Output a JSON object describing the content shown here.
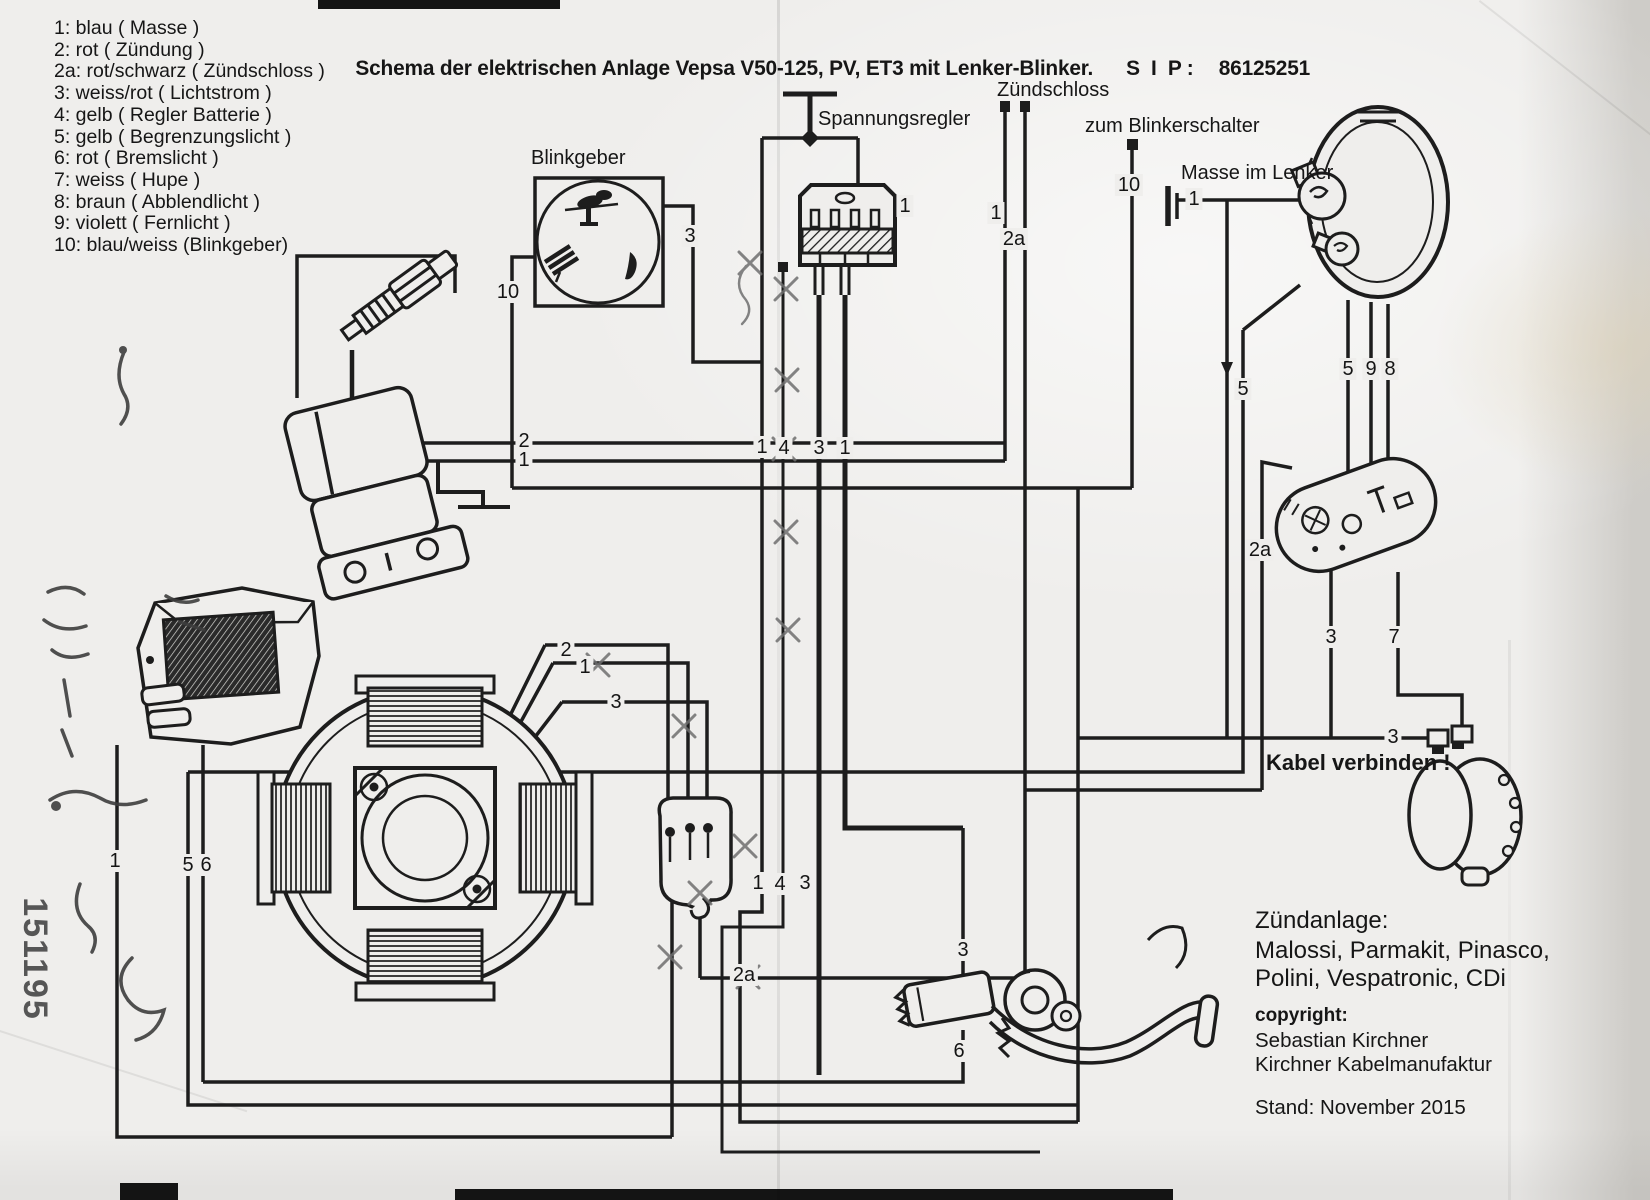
{
  "title": {
    "text": "Schema der elektrischen Anlage Vepsa V50-125, PV, ET3 mit Lenker-Blinker.",
    "sip_label": "S  I  P :",
    "sip_number": "86125251"
  },
  "legend": {
    "items": [
      "1: blau ( Masse )",
      "2: rot ( Zündung )",
      "2a: rot/schwarz ( Zündschloss )",
      "3: weiss/rot ( Lichtstrom )",
      "4: gelb ( Regler Batterie )",
      "5: gelb ( Begrenzungslicht )",
      "6: rot ( Bremslicht )",
      "7: weiss ( Hupe )",
      "8: braun ( Abblendlicht )",
      "9: violett ( Fernlicht )",
      "10: blau/weiss (Blinkgeber)"
    ]
  },
  "component_labels": {
    "blinkgeber": "Blinkgeber",
    "spannungsregler": "Spannungsregler",
    "zuendschloss": "Zündschloss",
    "zum_blinkerschalter": "zum Blinkerschalter",
    "masse_im_lenker": "Masse im Lenker",
    "kabel_verbinden": "Kabel verbinden !"
  },
  "info_block": {
    "ignition_title": "Zündanlage:",
    "ignition_line1": "Malossi, Parmakit, Pinasco,",
    "ignition_line2": "Polini, Vespatronic, CDi",
    "copyright_label": "copyright:",
    "copyright_name": "Sebastian Kirchner",
    "copyright_company": "Kirchner Kabelmanufaktur",
    "stand": "Stand: November 2015"
  },
  "handwritten_number": "151195",
  "colors": {
    "ink": "#1d1d1d",
    "paper": "#efeeec",
    "pencil": "#707070"
  },
  "wire_labels": [
    {
      "text": "3",
      "x": 690,
      "y": 236
    },
    {
      "text": "10",
      "x": 508,
      "y": 292
    },
    {
      "text": "1",
      "x": 905,
      "y": 206
    },
    {
      "text": "1",
      "x": 996,
      "y": 213
    },
    {
      "text": "2a",
      "x": 1014,
      "y": 239
    },
    {
      "text": "10",
      "x": 1129,
      "y": 185
    },
    {
      "text": "1",
      "x": 1194,
      "y": 199
    },
    {
      "text": "2",
      "x": 524,
      "y": 441
    },
    {
      "text": "1",
      "x": 524,
      "y": 460
    },
    {
      "text": "1",
      "x": 762,
      "y": 447
    },
    {
      "text": "4",
      "x": 784,
      "y": 448
    },
    {
      "text": "3",
      "x": 819,
      "y": 448
    },
    {
      "text": "1",
      "x": 845,
      "y": 448
    },
    {
      "text": "5",
      "x": 1243,
      "y": 389
    },
    {
      "text": "5",
      "x": 1348,
      "y": 369
    },
    {
      "text": "9",
      "x": 1371,
      "y": 369
    },
    {
      "text": "8",
      "x": 1390,
      "y": 369
    },
    {
      "text": "2a",
      "x": 1260,
      "y": 550
    },
    {
      "text": "3",
      "x": 1331,
      "y": 637
    },
    {
      "text": "7",
      "x": 1394,
      "y": 637
    },
    {
      "text": "3",
      "x": 1393,
      "y": 737
    },
    {
      "text": "2",
      "x": 566,
      "y": 650
    },
    {
      "text": "1",
      "x": 585,
      "y": 667
    },
    {
      "text": "3",
      "x": 616,
      "y": 702
    },
    {
      "text": "1",
      "x": 758,
      "y": 883
    },
    {
      "text": "4",
      "x": 780,
      "y": 884
    },
    {
      "text": "3",
      "x": 805,
      "y": 883
    },
    {
      "text": "2a",
      "x": 744,
      "y": 975
    },
    {
      "text": "3",
      "x": 963,
      "y": 950
    },
    {
      "text": "6",
      "x": 959,
      "y": 1051
    },
    {
      "text": "1",
      "x": 115,
      "y": 861
    },
    {
      "text": "5",
      "x": 188,
      "y": 865
    },
    {
      "text": "6",
      "x": 206,
      "y": 865
    }
  ]
}
